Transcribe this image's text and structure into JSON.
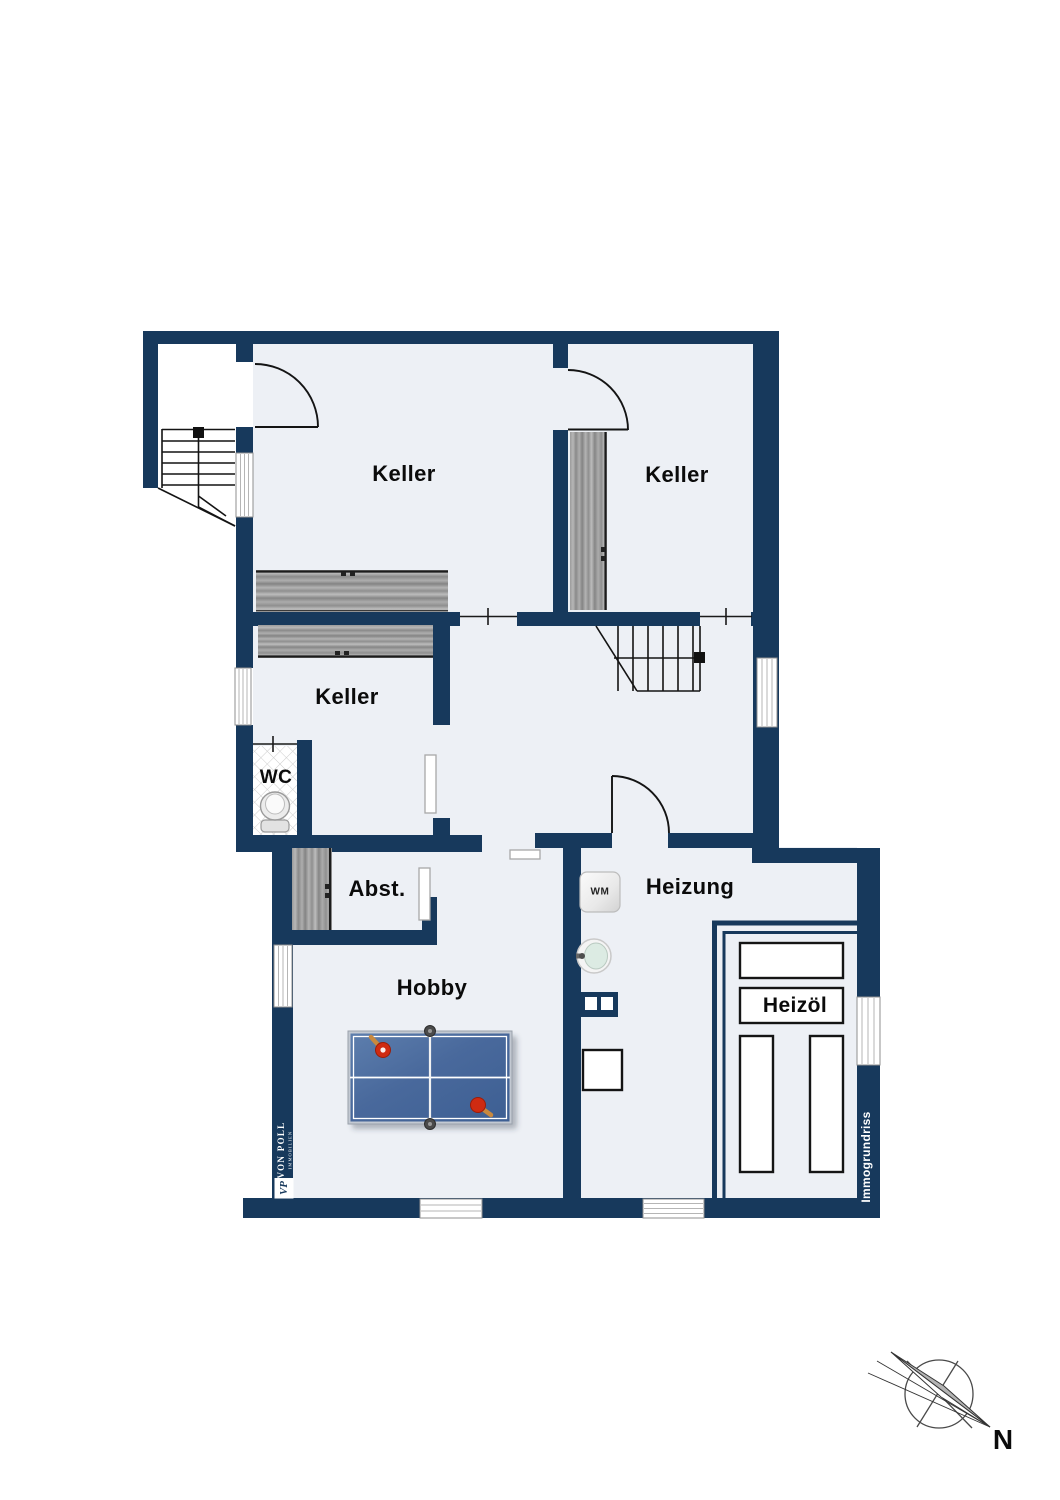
{
  "plan": {
    "type": "basement floor plan",
    "rooms": [
      {
        "id": "keller-1",
        "label": "Keller"
      },
      {
        "id": "keller-2",
        "label": "Keller"
      },
      {
        "id": "keller-3",
        "label": "Keller"
      },
      {
        "id": "wc",
        "label": "WC"
      },
      {
        "id": "abstellraum",
        "label": "Abst."
      },
      {
        "id": "hobby",
        "label": "Hobby"
      },
      {
        "id": "heizung",
        "label": "Heizung"
      },
      {
        "id": "heizoel",
        "label": "Heizöl"
      }
    ],
    "appliances": {
      "washing_machine": "WM"
    },
    "compass": {
      "north": "N"
    },
    "branding": {
      "agency": "VON POLL",
      "agency_sub": "IMMOBILIEN",
      "monogram": "VP",
      "watermark": "Immogrundriss"
    },
    "colors": {
      "wall": "#17395c",
      "floor": "#edf0f5",
      "line": "#141414",
      "wood": "#9a9a9a",
      "table_blue": "#49699c",
      "paddle_red": "#cf2b12",
      "paddle_handle": "#c8893f"
    }
  }
}
